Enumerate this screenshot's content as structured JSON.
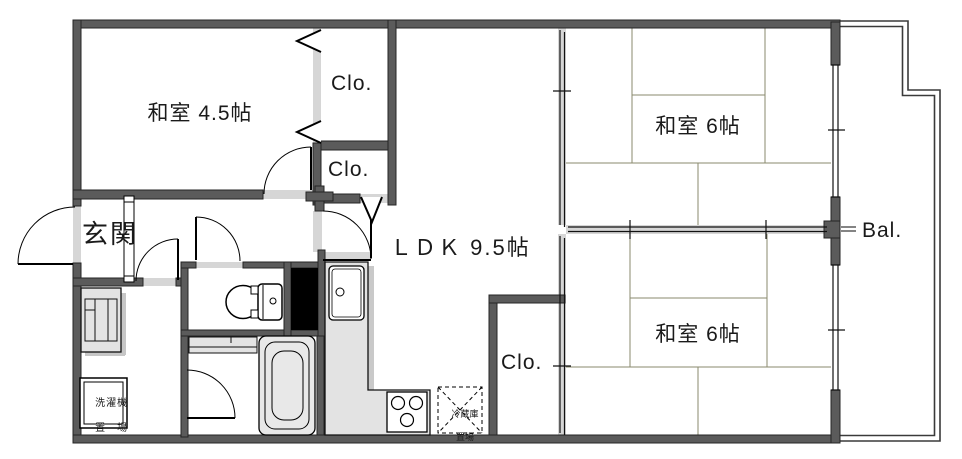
{
  "floorplan": {
    "rooms": {
      "washitsu_45": "和室 4.5帖",
      "washitsu_6_upper": "和室 6帖",
      "washitsu_6_lower": "和室 6帖",
      "ldk": "ＬＤＫ 9.5帖",
      "genkan": "玄関",
      "balcony": "Bal.",
      "closet_upper": "Clo.",
      "closet_middle": "Clo.",
      "closet_bottom": "Clo."
    },
    "fixtures": {
      "washing_machine_line1": "洗濯機",
      "washing_machine_line2": "置　場",
      "fridge_line1": "冷蔵庫",
      "fridge_line2": "置場"
    },
    "colors": {
      "wall": "#5b5b5b",
      "opening": "#d6d6d6",
      "fixture_fill": "#e3e3e3",
      "shadow": "#c6c6c6",
      "tatami_line": "#8a8a6e",
      "shaft": "#000000",
      "line": "#1a1a1a"
    }
  }
}
